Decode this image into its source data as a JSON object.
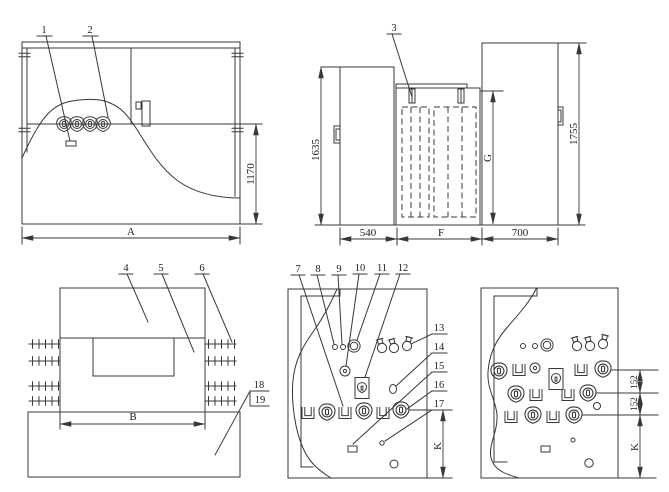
{
  "colors": {
    "line": "#383838",
    "background": "#ffffff"
  },
  "callouts": {
    "c1": "1",
    "c2": "2",
    "c3": "3",
    "c4": "4",
    "c5": "5",
    "c6": "6",
    "c7": "7",
    "c8": "8",
    "c9": "9",
    "c10": "10",
    "c11": "11",
    "c12": "12",
    "c13": "13",
    "c14": "14",
    "c15": "15",
    "c16": "16",
    "c17": "17",
    "c18": "18",
    "c19": "19"
  },
  "dimensions": {
    "front_height": "1170",
    "front_width": "A",
    "side_left_height": "1635",
    "side_left_width": "540",
    "side_mid_width": "F",
    "side_mid_height": "G",
    "side_right_width": "700",
    "side_right_height": "1755",
    "top_width": "B",
    "panel1_height": "K",
    "panel2_gap1": "152",
    "panel2_gap2": "152",
    "panel2_height": "K"
  }
}
